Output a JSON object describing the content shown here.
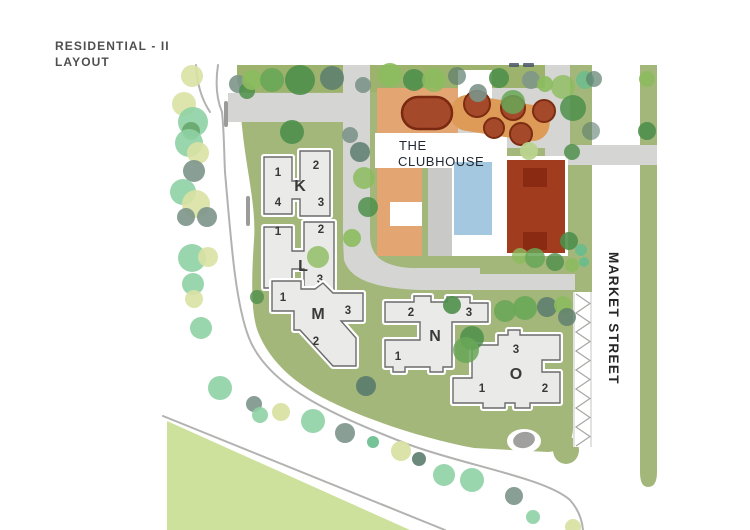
{
  "title": {
    "line1": "RESIDENTIAL - II",
    "line2": "LAYOUT"
  },
  "clubhouse": {
    "line1": "THE",
    "line2": "CLUBHOUSE"
  },
  "street": {
    "name": "MARKET STREET"
  },
  "buildings": [
    {
      "letter": "K",
      "units": [
        {
          "label": "1"
        },
        {
          "label": "2"
        },
        {
          "label": "4"
        },
        {
          "label": "3"
        }
      ]
    },
    {
      "letter": "L",
      "units": [
        {
          "label": "1"
        },
        {
          "label": "2"
        },
        {
          "label": "3"
        }
      ]
    },
    {
      "letter": "M",
      "units": [
        {
          "label": "1"
        },
        {
          "label": "3"
        },
        {
          "label": "2"
        }
      ]
    },
    {
      "letter": "N",
      "units": [
        {
          "label": "2"
        },
        {
          "label": "3"
        },
        {
          "label": "1"
        }
      ]
    },
    {
      "letter": "O",
      "units": [
        {
          "label": "3"
        },
        {
          "label": "1"
        },
        {
          "label": "2"
        }
      ]
    }
  ],
  "colors": {
    "site_green": "#a4b77a",
    "hedge_green": "#9db36d",
    "road_gray": "#d5d5d3",
    "building_fill": "#eaeae8",
    "building_stroke": "#6b6b6b",
    "clubhouse_tan": "#e3a672",
    "clubhouse_connector": "#dd9b57",
    "pool_blue": "#a3c8e0",
    "court_rust": "#a23c1e",
    "court_dark": "#8a2a12",
    "terracotta_tree": "#a5492b",
    "terracotta_stroke": "#7c2c10",
    "lawn_light": "#cde19d",
    "tree_mint": "#8ed1a4",
    "tree_yellow_green": "#d9e2a4",
    "tree_olive": "#8cbb5e",
    "tree_dark_green": "#4f8f4b",
    "tree_gray_green": "#7c948a"
  }
}
